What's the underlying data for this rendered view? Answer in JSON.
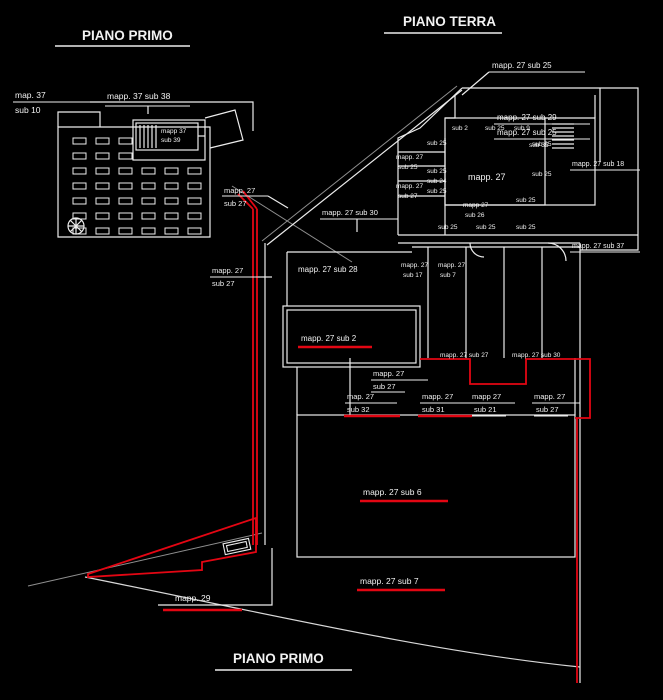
{
  "drawing": {
    "type": "cadastral-floor-plan",
    "background": "#000000",
    "colors": {
      "line": "#ececec",
      "grey": "#8f8f8f",
      "red": "#e30613",
      "text": "#f2f2f2"
    },
    "titles": {
      "top_left": "PIANO PRIMO",
      "top_right": "PIANO TERRA",
      "bottom_center": "PIANO PRIMO"
    },
    "labels": [
      {
        "name": "title-piano-primo-top",
        "text": "PIANO PRIMO",
        "x": 82,
        "y": 40,
        "size": 13.5,
        "bold": true,
        "ul": {
          "x1": 55,
          "y1": 46,
          "x2": 190,
          "y2": 46,
          "c": "line",
          "w": 1.4
        }
      },
      {
        "name": "title-piano-terra",
        "text": "PIANO TERRA",
        "x": 403,
        "y": 26,
        "size": 13.5,
        "bold": true,
        "ul": {
          "x1": 384,
          "y1": 33,
          "x2": 502,
          "y2": 33,
          "c": "line",
          "w": 1.4
        }
      },
      {
        "name": "title-piano-primo-bottom",
        "text": "PIANO PRIMO",
        "x": 233,
        "y": 663,
        "size": 13.5,
        "bold": true,
        "ul": {
          "x1": 215,
          "y1": 670,
          "x2": 352,
          "y2": 670,
          "c": "line",
          "w": 1.4
        }
      },
      {
        "name": "label-map-37",
        "text": "map. 37",
        "x": 15,
        "y": 98,
        "size": 8.5,
        "ul": {
          "x1": 13,
          "y1": 102,
          "x2": 90,
          "y2": 102,
          "c": "line",
          "w": 1
        }
      },
      {
        "name": "label-sub-10",
        "text": "sub 10",
        "x": 15,
        "y": 113,
        "size": 8.5
      },
      {
        "name": "label-mapp-37-sub-38",
        "text": "mapp. 37 sub 38",
        "x": 107,
        "y": 99,
        "size": 8.5,
        "ul": {
          "x1": 105,
          "y1": 106,
          "x2": 190,
          "y2": 106,
          "c": "line",
          "w": 1
        }
      },
      {
        "name": "label-mapp-37-box",
        "text": "mapp 37",
        "x": 161,
        "y": 133,
        "size": 6.5
      },
      {
        "name": "label-sub-39-box",
        "text": "sub 39",
        "x": 161,
        "y": 142,
        "size": 6.5
      },
      {
        "name": "label-mapp-27-sub-25-a",
        "text": "mapp. 27 sub 25",
        "x": 492,
        "y": 68,
        "size": 8,
        "ul": {
          "x1": 489,
          "y1": 72,
          "x2": 585,
          "y2": 72,
          "c": "line",
          "w": 1
        }
      },
      {
        "name": "label-mapp-27-sub-29",
        "text": "mapp. 27 sub 29",
        "x": 497,
        "y": 120,
        "size": 8,
        "ul": {
          "x1": 494,
          "y1": 124,
          "x2": 590,
          "y2": 124,
          "c": "line",
          "w": 1
        }
      },
      {
        "name": "label-mapp-27-sub-25-b",
        "text": "mapp. 27 sub 25",
        "x": 497,
        "y": 135,
        "size": 8,
        "ul": {
          "x1": 494,
          "y1": 139,
          "x2": 590,
          "y2": 139,
          "c": "line",
          "w": 1
        }
      },
      {
        "name": "label-sub-2",
        "text": "sub 2",
        "x": 452,
        "y": 130,
        "size": 6.5
      },
      {
        "name": "label-sub-25-c",
        "text": "sub 25",
        "x": 485,
        "y": 130,
        "size": 6.5
      },
      {
        "name": "label-sub-9",
        "text": "sub 9",
        "x": 514,
        "y": 130,
        "size": 6.5
      },
      {
        "name": "label-sub-35",
        "text": "sub 35",
        "x": 529,
        "y": 147,
        "size": 6.5
      },
      {
        "name": "label-mapp-27-sub-18",
        "text": "mapp. 27 sub 18",
        "x": 572,
        "y": 166,
        "size": 7,
        "ul": {
          "x1": 570,
          "y1": 170,
          "x2": 640,
          "y2": 170,
          "c": "line",
          "w": 1
        }
      },
      {
        "name": "label-mapp-27-sub-37",
        "text": "mapp. 27 sub 37",
        "x": 572,
        "y": 248,
        "size": 7,
        "ul": {
          "x1": 570,
          "y1": 252,
          "x2": 640,
          "y2": 252,
          "c": "line",
          "w": 1
        }
      },
      {
        "name": "label-sub-25-col-1",
        "text": "sub 25",
        "x": 427,
        "y": 145,
        "size": 6.5
      },
      {
        "name": "label-mapp-27-left-1",
        "text": "mapp. 27",
        "x": 396,
        "y": 159,
        "size": 6.5
      },
      {
        "name": "label-sub-25-left-1",
        "text": "sub 25",
        "x": 398,
        "y": 169,
        "size": 6.5
      },
      {
        "name": "label-sub-25-col-2",
        "text": "sub 25",
        "x": 427,
        "y": 173,
        "size": 6.5
      },
      {
        "name": "label-sub-24",
        "text": "sub 24",
        "x": 427,
        "y": 183,
        "size": 6.5
      },
      {
        "name": "label-sub-25-col-3",
        "text": "sub 25",
        "x": 427,
        "y": 193,
        "size": 6.5
      },
      {
        "name": "label-mapp-27-left-2",
        "text": "mapp. 27",
        "x": 396,
        "y": 188,
        "size": 6.5
      },
      {
        "name": "label-sub-27-left",
        "text": "sub 27",
        "x": 398,
        "y": 198,
        "size": 6.5
      },
      {
        "name": "label-mapp-27-room",
        "text": "mapp. 27",
        "x": 468,
        "y": 180,
        "size": 9
      },
      {
        "name": "label-sub-25-right-1",
        "text": "sub 25",
        "x": 532,
        "y": 146,
        "size": 6.5
      },
      {
        "name": "label-sub-25-right-2",
        "text": "sub 25",
        "x": 532,
        "y": 176,
        "size": 6.5
      },
      {
        "name": "label-sub-25-right-3",
        "text": "sub 25",
        "x": 516,
        "y": 202,
        "size": 6.5
      },
      {
        "name": "label-mapp-27-mid",
        "text": "mapp 27",
        "x": 463,
        "y": 207,
        "size": 6.5
      },
      {
        "name": "label-sub-26",
        "text": "sub 26",
        "x": 465,
        "y": 217,
        "size": 6.5
      },
      {
        "name": "label-sub-25-row-1",
        "text": "sub 25",
        "x": 438,
        "y": 229,
        "size": 6.5
      },
      {
        "name": "label-sub-25-row-2",
        "text": "sub 25",
        "x": 476,
        "y": 229,
        "size": 6.5
      },
      {
        "name": "label-sub-25-row-3",
        "text": "sub 25",
        "x": 516,
        "y": 229,
        "size": 6.5
      },
      {
        "name": "label-mapp-27-diag",
        "text": "mapp. 27",
        "x": 224,
        "y": 193,
        "size": 7.5,
        "ul": {
          "x1": 222,
          "y1": 196,
          "x2": 268,
          "y2": 196,
          "c": "line",
          "w": 1
        }
      },
      {
        "name": "label-sub-27-diag",
        "text": "sub 27",
        "x": 224,
        "y": 206,
        "size": 7.5
      },
      {
        "name": "label-mapp-27-sub-30-a",
        "text": "mapp. 27 sub 30",
        "x": 322,
        "y": 215,
        "size": 7.5,
        "ul": {
          "x1": 320,
          "y1": 219,
          "x2": 398,
          "y2": 219,
          "c": "line",
          "w": 1
        }
      },
      {
        "name": "label-mapp-27-low-left",
        "text": "mapp. 27",
        "x": 212,
        "y": 273,
        "size": 7.5,
        "ul": {
          "x1": 210,
          "y1": 277,
          "x2": 258,
          "y2": 277,
          "c": "line",
          "w": 1
        }
      },
      {
        "name": "label-sub-27-low-left",
        "text": "sub 27",
        "x": 212,
        "y": 286,
        "size": 7.5
      },
      {
        "name": "label-mapp-27-sub-28",
        "text": "mapp. 27 sub 28",
        "x": 298,
        "y": 272,
        "size": 8
      },
      {
        "name": "label-mapp-27-mid-1",
        "text": "mapp. 27",
        "x": 401,
        "y": 267,
        "size": 6.5
      },
      {
        "name": "label-sub-17-mid-1",
        "text": "sub 17",
        "x": 403,
        "y": 277,
        "size": 6.5
      },
      {
        "name": "label-mapp-27-mid-2",
        "text": "mapp. 27",
        "x": 438,
        "y": 267,
        "size": 6.5
      },
      {
        "name": "label-sub-7-mid-2",
        "text": "sub 7",
        "x": 440,
        "y": 277,
        "size": 6.5
      },
      {
        "name": "label-mapp-27-sub-2",
        "text": "mapp. 27 sub 2",
        "x": 301,
        "y": 341,
        "size": 8,
        "ul": {
          "x1": 298,
          "y1": 347,
          "x2": 372,
          "y2": 347,
          "c": "red",
          "w": 2.5
        }
      },
      {
        "name": "label-mapp-27-sub-27-row",
        "text": "mapp. 27 sub 27",
        "x": 440,
        "y": 357,
        "size": 6.5
      },
      {
        "name": "label-mapp-27-sub-30-b",
        "text": "mapp. 27 sub 30",
        "x": 512,
        "y": 357,
        "size": 6.5
      },
      {
        "name": "label-mapp-27-a",
        "text": "mapp. 27",
        "x": 373,
        "y": 376,
        "size": 7.5,
        "ul": {
          "x1": 371,
          "y1": 380,
          "x2": 428,
          "y2": 380,
          "c": "line",
          "w": 1
        }
      },
      {
        "name": "label-sub-27-a",
        "text": "sub 27",
        "x": 373,
        "y": 389,
        "size": 7.5,
        "ul": {
          "x1": 371,
          "y1": 392,
          "x2": 405,
          "y2": 392,
          "c": "line",
          "w": 1
        }
      },
      {
        "name": "label-map-27-b",
        "text": "map. 27",
        "x": 347,
        "y": 399,
        "size": 7.5,
        "ul": {
          "x1": 345,
          "y1": 403,
          "x2": 397,
          "y2": 403,
          "c": "line",
          "w": 1
        }
      },
      {
        "name": "label-sub-32",
        "text": "sub 32",
        "x": 347,
        "y": 412,
        "size": 7.5,
        "ul": {
          "x1": 344,
          "y1": 416,
          "x2": 400,
          "y2": 416,
          "c": "red",
          "w": 2.5
        }
      },
      {
        "name": "label-mapp-27-c",
        "text": "mapp. 27",
        "x": 422,
        "y": 399,
        "size": 7.5,
        "ul": {
          "x1": 420,
          "y1": 403,
          "x2": 470,
          "y2": 403,
          "c": "line",
          "w": 1
        }
      },
      {
        "name": "label-sub-31",
        "text": "sub 31",
        "x": 422,
        "y": 412,
        "size": 7.5,
        "ul": {
          "x1": 418,
          "y1": 416,
          "x2": 472,
          "y2": 416,
          "c": "red",
          "w": 2.5
        }
      },
      {
        "name": "label-mapp-27-d",
        "text": "mapp 27",
        "x": 472,
        "y": 399,
        "size": 7.5,
        "ul": {
          "x1": 470,
          "y1": 403,
          "x2": 515,
          "y2": 403,
          "c": "line",
          "w": 1
        }
      },
      {
        "name": "label-sub-21",
        "text": "sub 21",
        "x": 474,
        "y": 412,
        "size": 7.5,
        "ul": {
          "x1": 472,
          "y1": 416,
          "x2": 506,
          "y2": 416,
          "c": "line",
          "w": 1
        }
      },
      {
        "name": "label-mapp-27-e",
        "text": "mapp. 27",
        "x": 534,
        "y": 399,
        "size": 7.5,
        "ul": {
          "x1": 532,
          "y1": 403,
          "x2": 580,
          "y2": 403,
          "c": "line",
          "w": 1
        }
      },
      {
        "name": "label-sub-27-e",
        "text": "sub 27",
        "x": 536,
        "y": 412,
        "size": 7.5,
        "ul": {
          "x1": 534,
          "y1": 416,
          "x2": 568,
          "y2": 416,
          "c": "line",
          "w": 1
        }
      },
      {
        "name": "label-mapp-27-sub-6",
        "text": "mapp. 27 sub 6",
        "x": 363,
        "y": 495,
        "size": 8.5,
        "ul": {
          "x1": 360,
          "y1": 501,
          "x2": 448,
          "y2": 501,
          "c": "red",
          "w": 2.5
        }
      },
      {
        "name": "label-mapp-27-sub-7",
        "text": "mapp. 27 sub 7",
        "x": 360,
        "y": 584,
        "size": 8.5,
        "ul": {
          "x1": 357,
          "y1": 590,
          "x2": 445,
          "y2": 590,
          "c": "red",
          "w": 2.5
        }
      },
      {
        "name": "label-mapp-29",
        "text": "mapp. 29",
        "x": 175,
        "y": 601,
        "size": 8.5,
        "ul": {
          "x1": 163,
          "y1": 610,
          "x2": 242,
          "y2": 610,
          "c": "red",
          "w": 2.5
        }
      }
    ]
  }
}
